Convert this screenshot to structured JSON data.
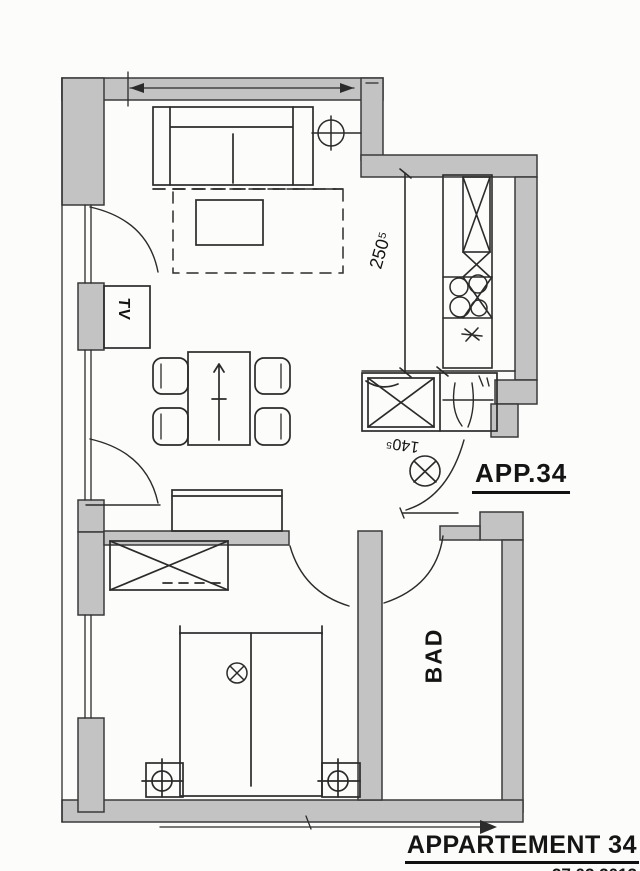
{
  "labels": {
    "apartment_number": "APP.34",
    "bathroom": "BAD",
    "tv": "TV"
  },
  "dimensions": {
    "kitchen_wall": "250⁵",
    "hall_niche": "140⁵"
  },
  "title_block": {
    "title": "APPARTEMENT 34",
    "date": "27.02.2013"
  },
  "colors": {
    "wall_fill": "#c3c3c3",
    "line": "#2b2b2b",
    "paper": "#fcfcfa"
  }
}
